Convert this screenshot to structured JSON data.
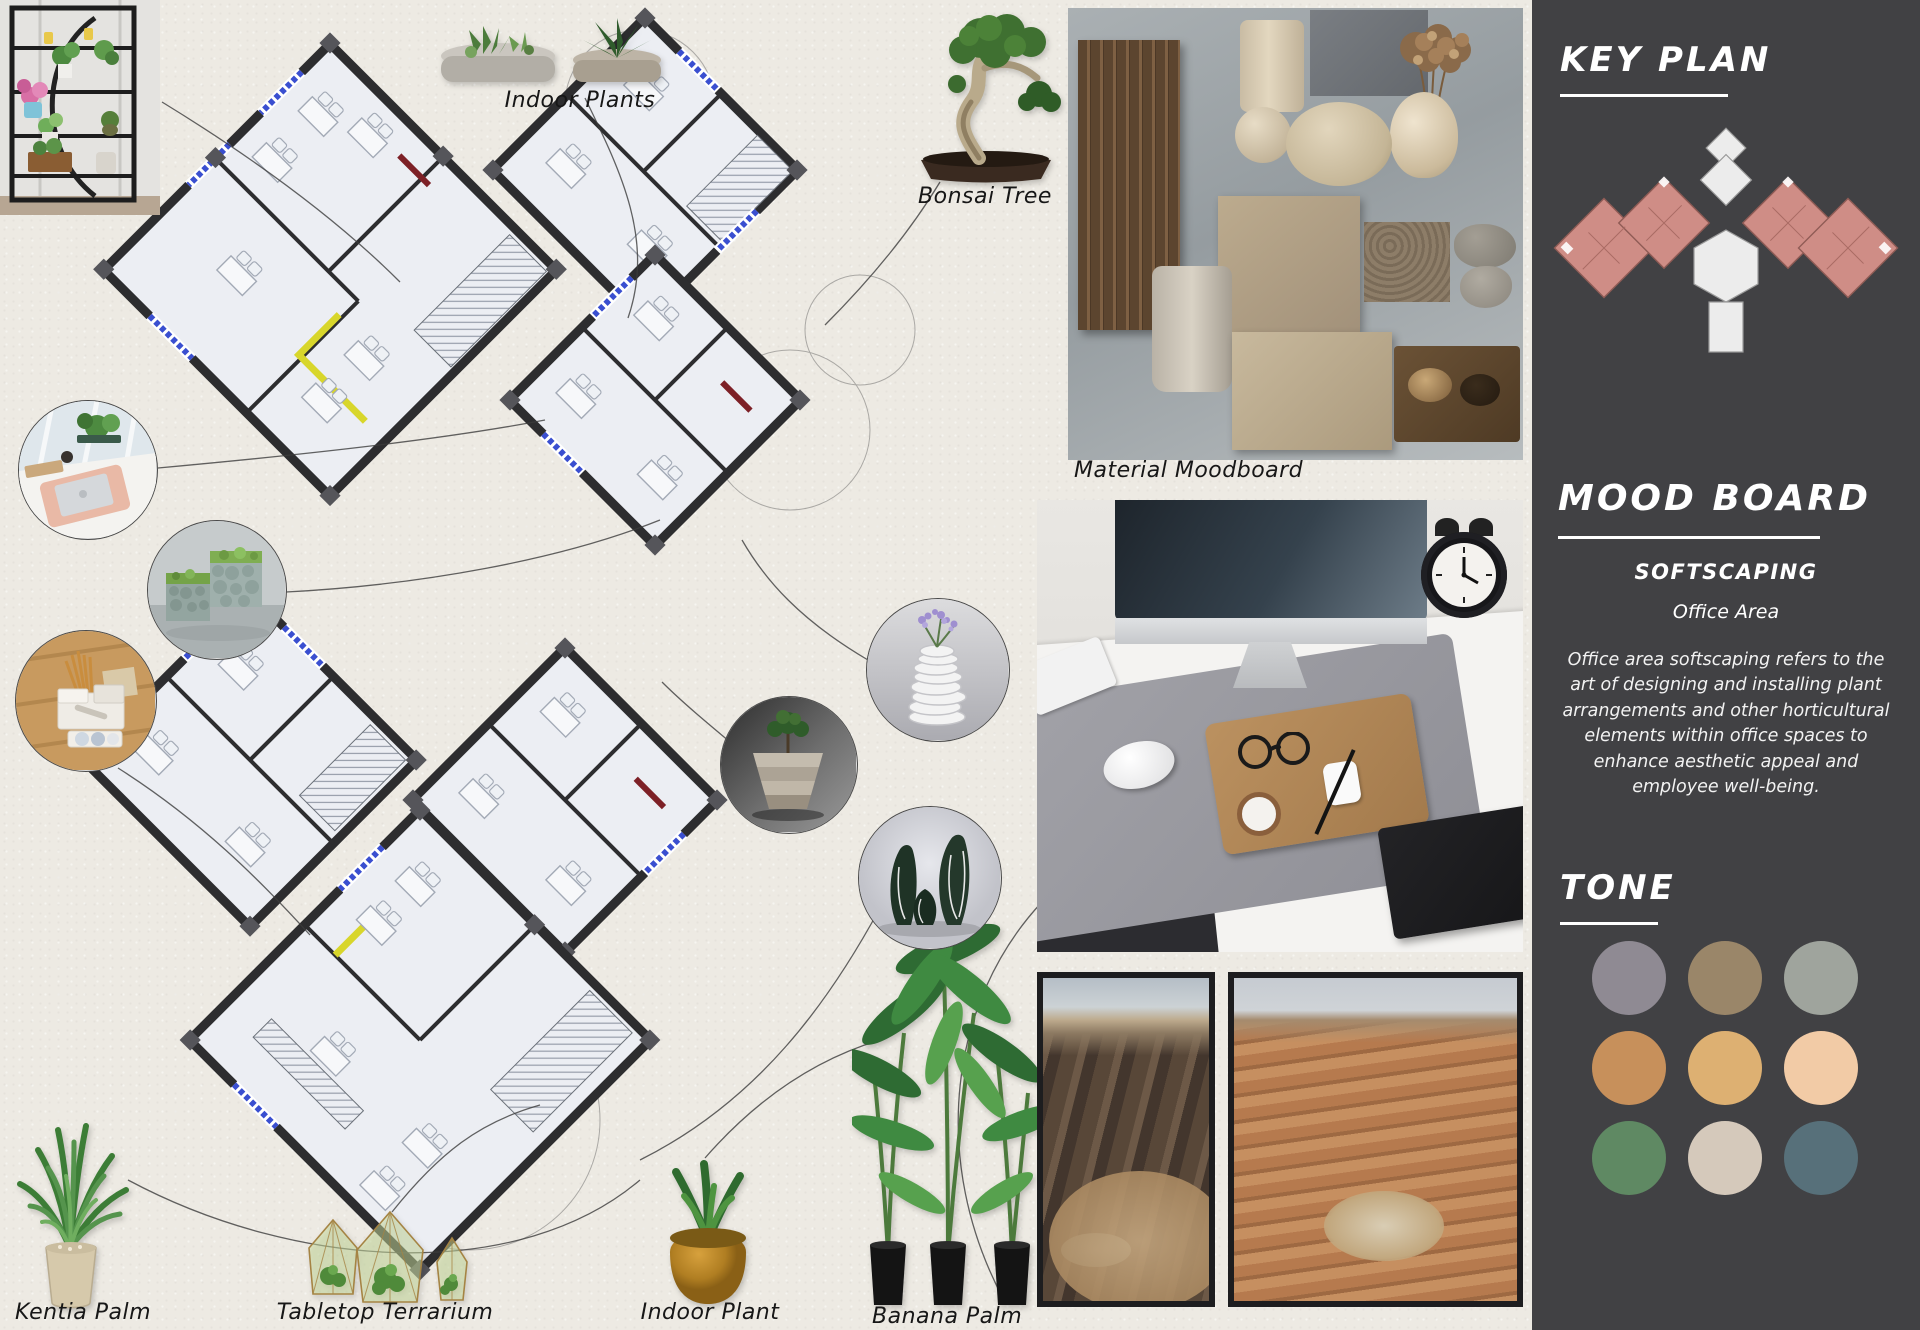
{
  "labels": {
    "indoor_plants": "Indoor Plants",
    "bonsai_tree": "Bonsai Tree",
    "material_moodboard": "Material Moodboard",
    "kentia_palm": "Kentia Palm",
    "tabletop_terrarium": "Tabletop Terrarium",
    "indoor_plant": "Indoor Plant",
    "banana_palm": "Banana Palm"
  },
  "sidebar": {
    "background": "#414144",
    "key_plan": {
      "title": "KEY PLAN"
    },
    "mood_board": {
      "title": "MOOD BOARD",
      "subtitle": "SOFTSCAPING",
      "area_label": "Office Area",
      "description": "Office area softscaping refers to the art of designing and installing plant arrangements and other horticultural elements within office spaces to enhance aesthetic appeal and employee well-being."
    },
    "tone": {
      "title": "TONE",
      "swatches": [
        {
          "name": "mauve-gray",
          "hex": "#8F8A93"
        },
        {
          "name": "taupe-brown",
          "hex": "#9A8669"
        },
        {
          "name": "sage-gray",
          "hex": "#9FA49D"
        },
        {
          "name": "copper-tan",
          "hex": "#C7905B"
        },
        {
          "name": "golden-sand",
          "hex": "#DDB072"
        },
        {
          "name": "soft-peach",
          "hex": "#F2CBA6"
        },
        {
          "name": "moss-green",
          "hex": "#5F8963"
        },
        {
          "name": "warm-beige",
          "hex": "#D5C9BB"
        },
        {
          "name": "slate-teal",
          "hex": "#57707A"
        }
      ]
    }
  },
  "plan_colors": {
    "wall": "#2D2D2F",
    "room_fill": "#ECEEF3",
    "window_blue": "#3A4FD0",
    "accent_yellow": "#D8D62B",
    "accent_red": "#7D2026",
    "keyplan_rose": "#CF8D86"
  }
}
